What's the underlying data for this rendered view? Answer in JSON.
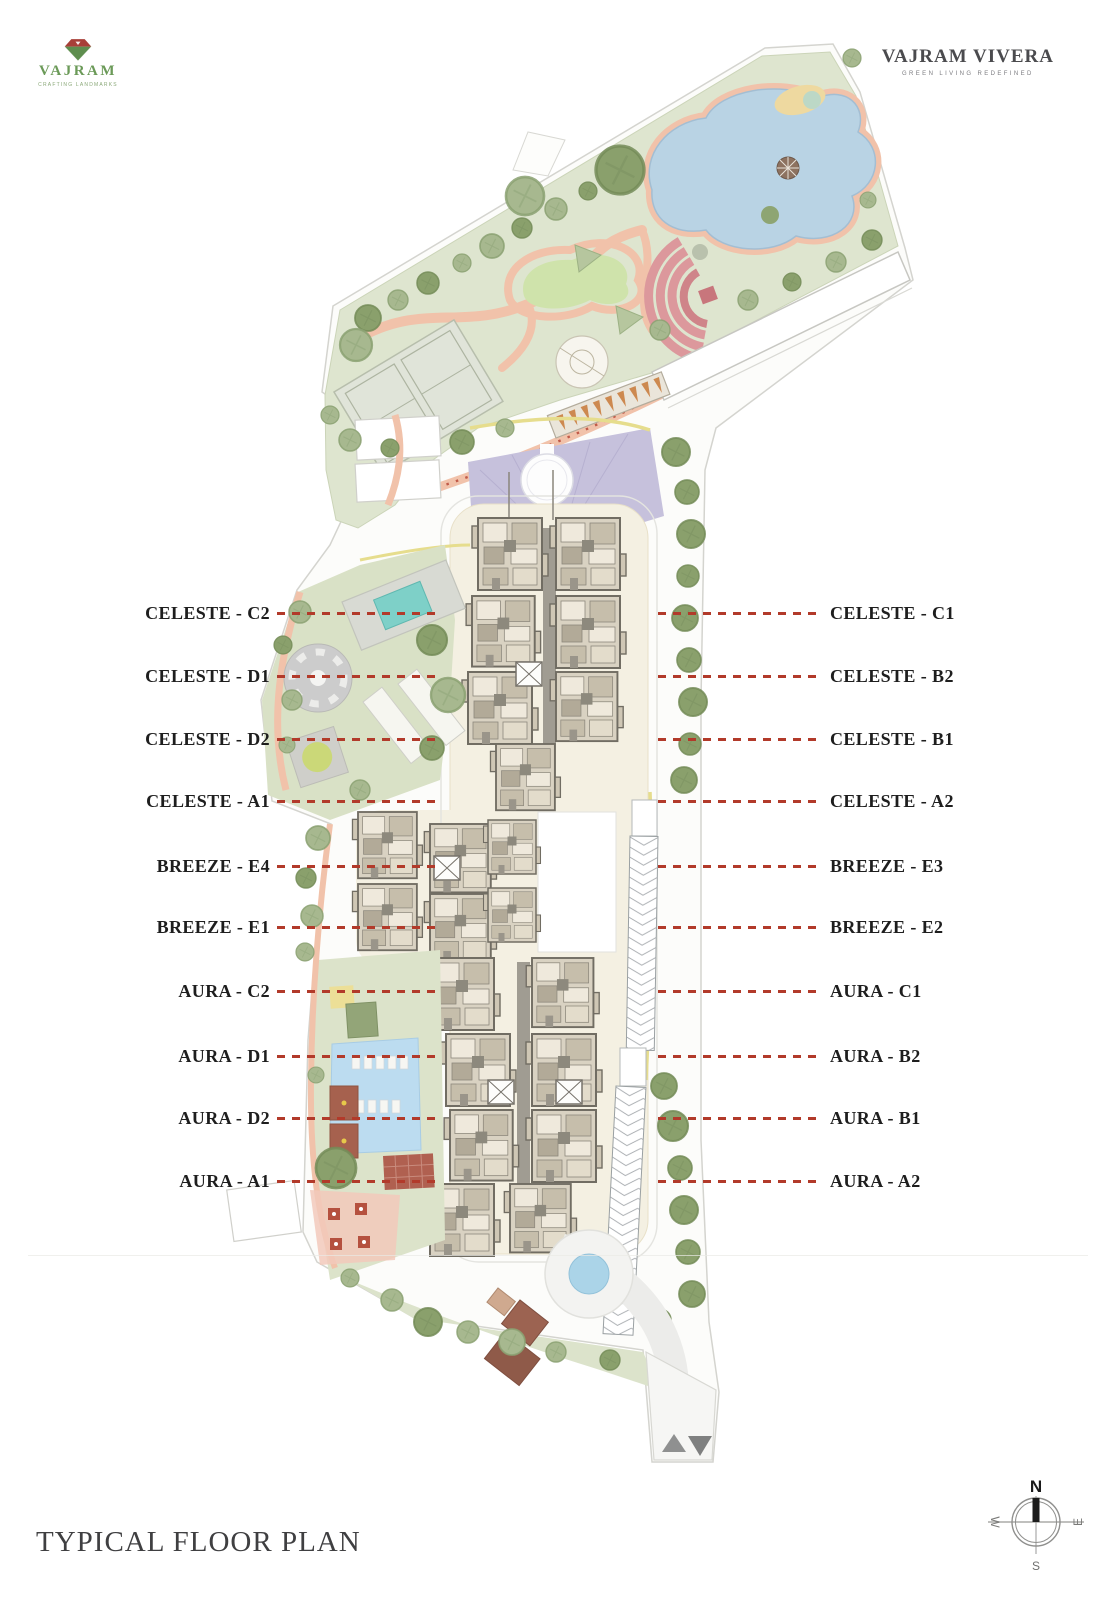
{
  "header": {
    "logo": {
      "brand": "VAJRAM",
      "tagline": "CRAFTING LANDMARKS"
    },
    "wordmark": {
      "title": "VAJRAM VIVERA",
      "tagline": "GREEN LIVING REDEFINED"
    }
  },
  "plan_labels": {
    "left": [
      "CELESTE - C2",
      "CELESTE - D1",
      "CELESTE - D2",
      "CELESTE - A1",
      "BREEZE - E4",
      "BREEZE - E1",
      "AURA - C2",
      "AURA - D1",
      "AURA - D2",
      "AURA - A1"
    ],
    "right": [
      "CELESTE - C1",
      "CELESTE - B2",
      "CELESTE - B1",
      "CELESTE - A2",
      "BREEZE - E3",
      "BREEZE - E2",
      "AURA - C1",
      "AURA - B2",
      "AURA - B1",
      "AURA - A2"
    ],
    "row_y": [
      613,
      676,
      739,
      801,
      866,
      927,
      991,
      1056,
      1118,
      1181
    ]
  },
  "compass": {
    "north": "N",
    "south": "S",
    "east": "E",
    "west": "W"
  },
  "footer": {
    "title": "TYPICAL FLOOR PLAN"
  },
  "icons": {
    "logo_mark": "gem-diamond",
    "compass": "compass-rose",
    "entry_arrows": "up-down-triangles"
  },
  "colors": {
    "leader_line": "#b23a2a",
    "label_text": "#1e1e1e",
    "logo_green": "#6b9a58",
    "logo_red": "#a83f38",
    "wordmark_gray": "#4b4b4e",
    "park_green": "#dee5cf",
    "pond_blue": "#b9d3e4",
    "path_salmon": "#f1c2aa",
    "cream_band": "#f4f0e2",
    "plaza_purple": "#c6c1dc",
    "pool_teal": "#7ed0c8",
    "pool_blue": "#bcdcf0",
    "deck_red": "#a6614e",
    "title_gray": "#3f3f41"
  }
}
